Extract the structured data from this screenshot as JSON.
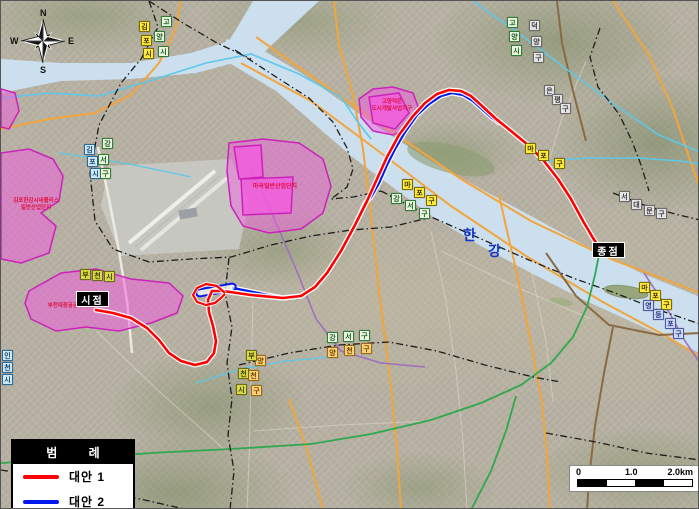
{
  "colors": {
    "alt1": "#ff0000",
    "alt2": "#0018ee",
    "zone_fill": "#f558e2",
    "zone_border": "#cc22bb",
    "zone_text": "#e01040",
    "river": "#ccdfee",
    "river_label": "#1535c8",
    "boundary": "#1c1c1c",
    "road_orange": "#f2a53c",
    "road_brown": "#8a6a42",
    "road_green": "#2fa84f",
    "road_cyan": "#5ec8e8",
    "road_purple": "#9f6fc0",
    "airport": "#c9c9c4"
  },
  "legend": {
    "title": "범 례",
    "items": [
      {
        "label": "대안 1"
      },
      {
        "label": "대안 2"
      }
    ]
  },
  "markers": {
    "start": "시점",
    "end": "종점"
  },
  "river": {
    "char1": "한",
    "char2": "강"
  },
  "compass": {
    "n": "N",
    "e": "E",
    "s": "S",
    "w": "W"
  },
  "scalebar": {
    "tick0": "0",
    "tick1": "1.0",
    "tick2": "2.0km"
  },
  "zones": [
    {
      "name": "west-district",
      "line1": "김포한강시네폴리스",
      "line2": "일반산업단지"
    },
    {
      "name": "start-district",
      "line1": "부천대장공공주택지구",
      "line2": ""
    },
    {
      "name": "magok-district",
      "line1": "마곡일반산업단지",
      "line2": ""
    },
    {
      "name": "deogeun-district",
      "line1": "고양덕은",
      "line2": "도시개발사업지구"
    }
  ],
  "map_labels": [
    {
      "name": "goyang-si-1",
      "style": "green",
      "chars": [
        {
          "c": "고",
          "x": 160,
          "y": 15
        },
        {
          "c": "양",
          "x": 153,
          "y": 30
        },
        {
          "c": "시",
          "x": 157,
          "y": 45
        }
      ]
    },
    {
      "name": "gimpo-si-1",
      "style": "yellow",
      "chars": [
        {
          "c": "김",
          "x": 138,
          "y": 20
        },
        {
          "c": "포",
          "x": 140,
          "y": 34
        },
        {
          "c": "시",
          "x": 142,
          "y": 47
        }
      ]
    },
    {
      "name": "goyang-si-2",
      "style": "green",
      "chars": [
        {
          "c": "고",
          "x": 506,
          "y": 16
        },
        {
          "c": "양",
          "x": 508,
          "y": 30
        },
        {
          "c": "시",
          "x": 510,
          "y": 44
        }
      ]
    },
    {
      "name": "deogyang-gu",
      "style": "gray",
      "chars": [
        {
          "c": "덕",
          "x": 528,
          "y": 19
        },
        {
          "c": "양",
          "x": 530,
          "y": 35
        },
        {
          "c": "구",
          "x": 532,
          "y": 51
        }
      ]
    },
    {
      "name": "eunpyeong-gu",
      "style": "gray",
      "chars": [
        {
          "c": "은",
          "x": 543,
          "y": 84
        },
        {
          "c": "평",
          "x": 551,
          "y": 93
        },
        {
          "c": "구",
          "x": 559,
          "y": 102
        }
      ]
    },
    {
      "name": "seodaemun-gu",
      "style": "gray",
      "chars": [
        {
          "c": "서",
          "x": 618,
          "y": 190
        },
        {
          "c": "대",
          "x": 630,
          "y": 198
        },
        {
          "c": "문",
          "x": 643,
          "y": 204
        },
        {
          "c": "구",
          "x": 655,
          "y": 207
        }
      ]
    },
    {
      "name": "mapo-gu-1",
      "style": "yellow",
      "chars": [
        {
          "c": "마",
          "x": 401,
          "y": 178
        },
        {
          "c": "포",
          "x": 413,
          "y": 186
        },
        {
          "c": "구",
          "x": 425,
          "y": 194
        }
      ]
    },
    {
      "name": "mapo-gu-2",
      "style": "yellow",
      "chars": [
        {
          "c": "마",
          "x": 524,
          "y": 142
        },
        {
          "c": "포",
          "x": 537,
          "y": 149
        },
        {
          "c": "구",
          "x": 553,
          "y": 157
        }
      ]
    },
    {
      "name": "mapo-gu-3",
      "style": "yellow",
      "chars": [
        {
          "c": "마",
          "x": 638,
          "y": 281
        },
        {
          "c": "포",
          "x": 649,
          "y": 289
        },
        {
          "c": "구",
          "x": 660,
          "y": 298
        }
      ]
    },
    {
      "name": "yeongdeungpo-gu",
      "style": "lavender",
      "chars": [
        {
          "c": "영",
          "x": 642,
          "y": 299
        },
        {
          "c": "등",
          "x": 652,
          "y": 308
        },
        {
          "c": "포",
          "x": 664,
          "y": 317
        },
        {
          "c": "구",
          "x": 672,
          "y": 327
        }
      ]
    },
    {
      "name": "gangseo-gu-1",
      "style": "green",
      "chars": [
        {
          "c": "강",
          "x": 390,
          "y": 192
        },
        {
          "c": "서",
          "x": 404,
          "y": 199
        },
        {
          "c": "구",
          "x": 418,
          "y": 207
        }
      ]
    },
    {
      "name": "gangseo-gu-2",
      "style": "green",
      "chars": [
        {
          "c": "강",
          "x": 326,
          "y": 331
        },
        {
          "c": "서",
          "x": 342,
          "y": 330
        },
        {
          "c": "구",
          "x": 358,
          "y": 329
        }
      ]
    },
    {
      "name": "yangcheon-gu-1",
      "style": "orange",
      "chars": [
        {
          "c": "양",
          "x": 326,
          "y": 346
        },
        {
          "c": "천",
          "x": 343,
          "y": 344
        },
        {
          "c": "구",
          "x": 360,
          "y": 342
        }
      ]
    },
    {
      "name": "yangcheon-gu-2",
      "style": "orange",
      "chars": [
        {
          "c": "양",
          "x": 254,
          "y": 354
        },
        {
          "c": "천",
          "x": 247,
          "y": 369
        },
        {
          "c": "구",
          "x": 250,
          "y": 384
        }
      ]
    },
    {
      "name": "bucheon-si-1",
      "style": "olive",
      "chars": [
        {
          "c": "부",
          "x": 79,
          "y": 268
        },
        {
          "c": "천",
          "x": 91,
          "y": 269
        },
        {
          "c": "시",
          "x": 103,
          "y": 270
        }
      ]
    },
    {
      "name": "bucheon-si-2",
      "style": "olive",
      "chars": [
        {
          "c": "부",
          "x": 245,
          "y": 349
        },
        {
          "c": "천",
          "x": 237,
          "y": 367
        },
        {
          "c": "시",
          "x": 235,
          "y": 383
        }
      ]
    },
    {
      "name": "gimpo-si-2",
      "style": "blue",
      "chars": [
        {
          "c": "김",
          "x": 83,
          "y": 143
        },
        {
          "c": "포",
          "x": 86,
          "y": 155
        },
        {
          "c": "시",
          "x": 89,
          "y": 167
        }
      ]
    },
    {
      "name": "gangseo-gu-3",
      "style": "green",
      "chars": [
        {
          "c": "강",
          "x": 101,
          "y": 137
        },
        {
          "c": "서",
          "x": 97,
          "y": 153
        },
        {
          "c": "구",
          "x": 99,
          "y": 167
        }
      ]
    },
    {
      "name": "incheon-si",
      "style": "blue",
      "chars": [
        {
          "c": "인",
          "x": 1,
          "y": 349
        },
        {
          "c": "천",
          "x": 1,
          "y": 361
        },
        {
          "c": "시",
          "x": 1,
          "y": 373
        }
      ]
    }
  ]
}
